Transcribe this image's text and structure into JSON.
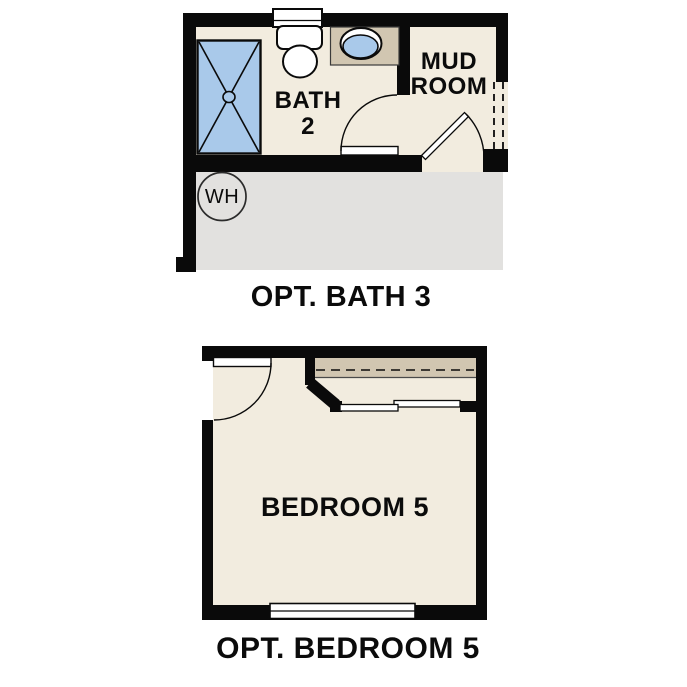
{
  "palette": {
    "wall_black": "#0a0a0a",
    "floor_beige": "#f2ecdf",
    "counter_tan": "#d1c6b1",
    "fixture_blue": "#a9c9ea",
    "adjacent_gray": "#e2e1df",
    "fixture_white": "#ffffff",
    "text_black": "#0b0b0b"
  },
  "plans": {
    "bath3": {
      "caption": "OPT. BATH 3",
      "bath_label_line1": "BATH",
      "bath_label_line2": "2",
      "mudroom_label_line1": "MUD",
      "mudroom_label_line2": "ROOM",
      "water_heater_label": "WH"
    },
    "bedroom5": {
      "caption": "OPT. BEDROOM 5",
      "room_label": "BEDROOM 5"
    }
  }
}
